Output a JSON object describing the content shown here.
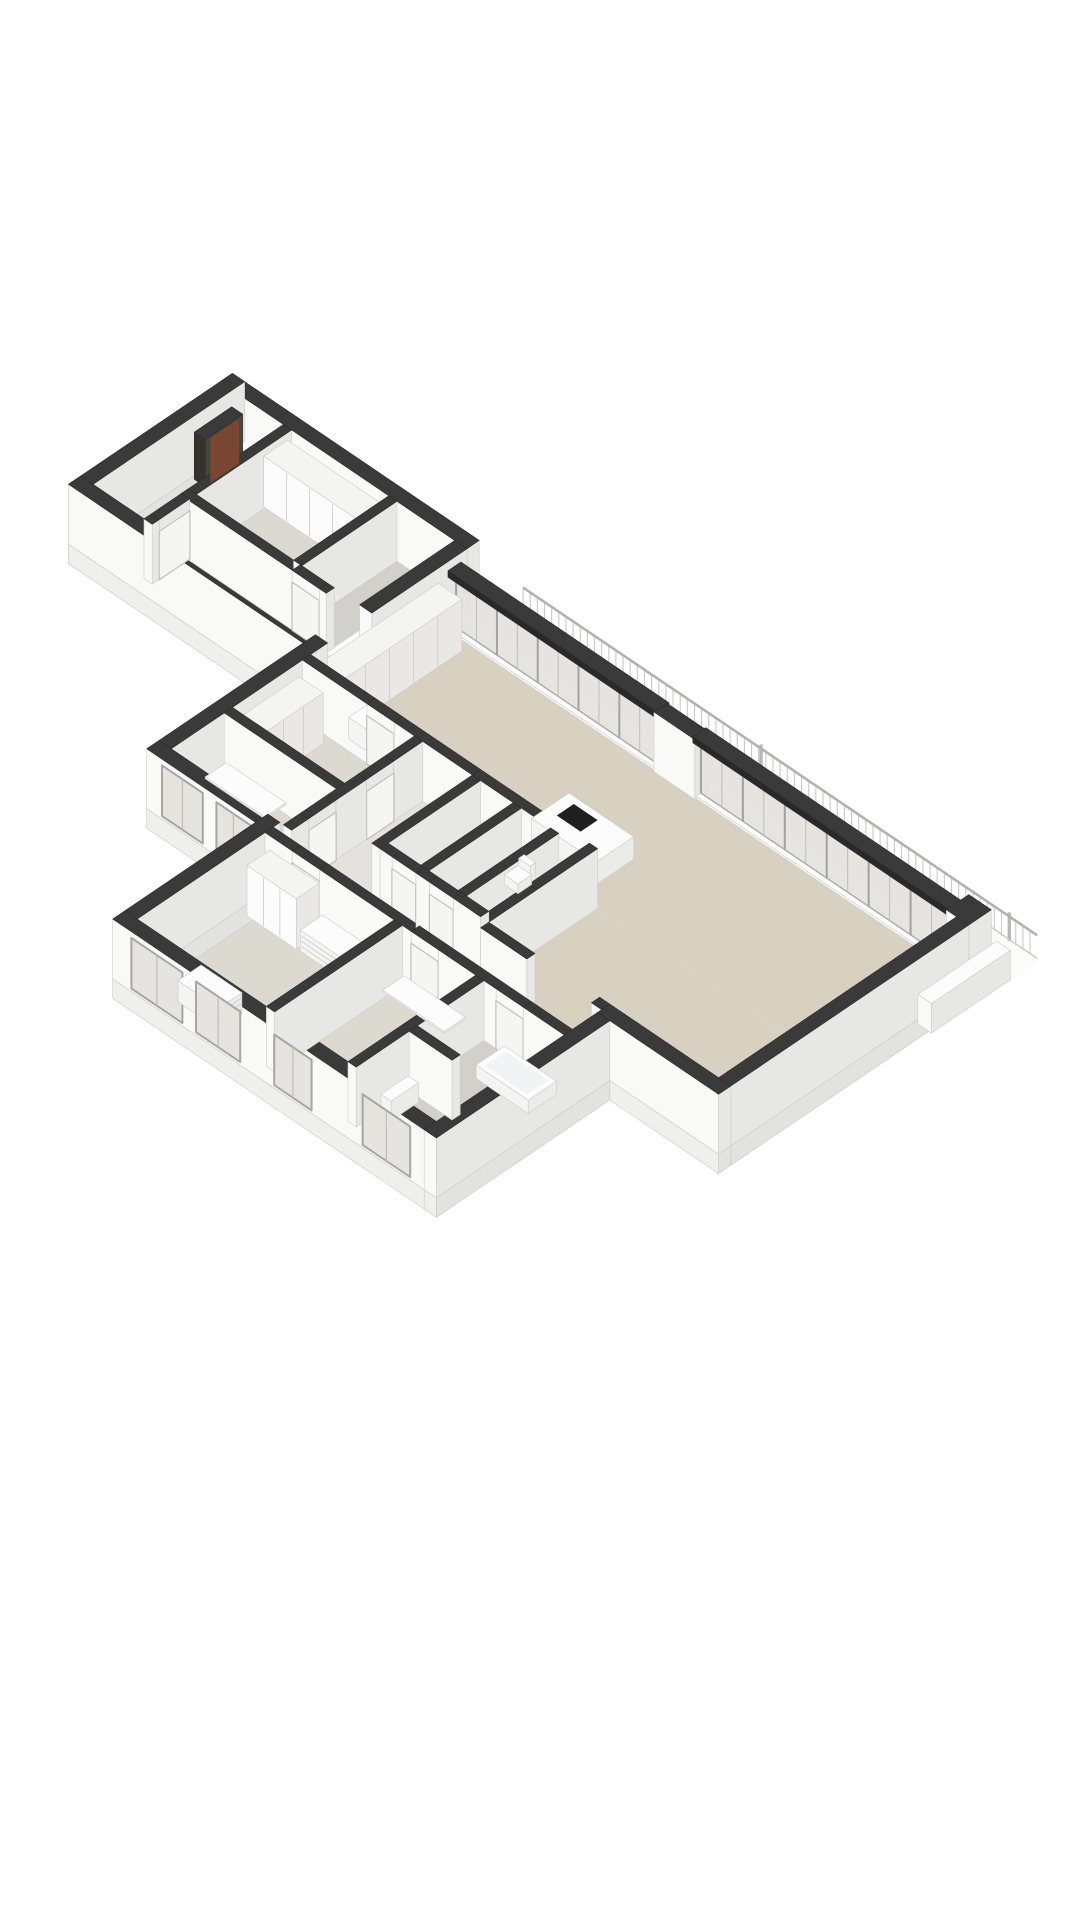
{
  "scene": {
    "kind": "isometric-3d-floorplan-render",
    "background": "#ffffff",
    "palette": {
      "cap": "#3a3a3b",
      "capEdge": "#2c2c2d",
      "capDark": "#29292a",
      "wallLight": "#f9f9f8",
      "wallShade": "#e7e7e6",
      "wallDim": "#dadad9",
      "floorBeige": "#d8d1c2",
      "floorGreige": "#dcd9d1",
      "floorGray": "#d2d0cb",
      "floorPale": "#e4e2de",
      "balcony": "#fbfbfa",
      "glass": "#e5e3de",
      "frame": "#a2a2a1",
      "frameThin": "#bdbdbc",
      "white": "#fcfcfc",
      "furnSide": "#f4f4f3",
      "furnShade": "#ebebe9",
      "cooktop": "#1f1f20",
      "slab": "#efefee",
      "slabSide": "#e2e2e1",
      "slabEdge": "#c9c9c8",
      "railing": "#c9c9c8",
      "railTop": "#b2b2b1",
      "post": "#b8b8b7",
      "door": "#f5f5f4",
      "doorStroke": "#b5b5b4",
      "cabinetFront": "#e9e8e6",
      "seam": "#c9c9c8",
      "meterDark": "#38322e",
      "meterFace": "#4a433e",
      "meterBrown": "#7a4531",
      "tubInner": "#f1f3f4",
      "faceStroke": "#cccccb"
    },
    "floors": [
      {
        "name": "balcony-terrace-floor",
        "rect": [
          0,
          -1.32,
          16.1,
          -0.36
        ],
        "color": "balcony"
      },
      {
        "name": "living-room-floor",
        "rect": [
          0,
          0,
          15.2,
          4.1
        ],
        "color": "floorBeige"
      },
      {
        "name": "living-room-floor-east",
        "rect": [
          8.44,
          4.1,
          15.2,
          7.3
        ],
        "color": "floorBeige"
      },
      {
        "name": "west-hall-floor",
        "rect": [
          3.54,
          4.34,
          5.0,
          7.3
        ],
        "color": "floorPale"
      },
      {
        "name": "core-storage-floor",
        "rect": [
          5.24,
          4.34,
          6.2,
          7.06
        ],
        "color": "floorGray"
      },
      {
        "name": "core-wc-floor",
        "rect": [
          6.44,
          4.34,
          7.3,
          7.06
        ],
        "color": "floorGray"
      },
      {
        "name": "core-shower-floor",
        "rect": [
          7.54,
          4.34,
          8.2,
          7.06
        ],
        "color": "floorGray"
      },
      {
        "name": "west-bedroom-floor",
        "rect": [
          0,
          4.34,
          3.3,
          6.4
        ],
        "color": "floorGreige"
      },
      {
        "name": "west-study-floor",
        "rect": [
          0,
          6.64,
          3.3,
          8.2
        ],
        "color": "floorGreige"
      },
      {
        "name": "south-hall-floor",
        "rect": [
          3.2,
          7.3,
          12.0,
          8.4
        ],
        "color": "floorBeige"
      },
      {
        "name": "bedroom-a-floor",
        "rect": [
          3.2,
          8.64,
          7.0,
          12.4
        ],
        "color": "floorGreige"
      },
      {
        "name": "bedroom-b-floor",
        "rect": [
          7.24,
          8.64,
          9.4,
          12.4
        ],
        "color": "floorGreige"
      },
      {
        "name": "bathroom-floor",
        "rect": [
          9.64,
          8.64,
          12.0,
          12.4
        ],
        "color": "floorGray"
      },
      {
        "name": "entry-room-floor",
        "rect": [
          -5.4,
          -0.5,
          -2.3,
          2.3
        ],
        "color": "floorGreige"
      },
      {
        "name": "entry-closet-floor",
        "rect": [
          -2.06,
          -0.5,
          -1.1,
          2.3
        ],
        "color": "floorGray"
      },
      {
        "name": "entry-corridor-floor",
        "rect": [
          -5.4,
          2.54,
          0,
          3.6
        ],
        "color": "floorPale"
      },
      {
        "name": "vestibule-floor",
        "rect": [
          -6.9,
          -0.5,
          -5.4,
          3.6
        ],
        "color": "floorPale"
      }
    ],
    "slab_edges": [
      {
        "name": "slab-south",
        "rect": [
          2.84,
          12.4,
          12.36,
          12.76
        ]
      },
      {
        "name": "slab-westblock-south",
        "rect": [
          -0.36,
          8.2,
          2.84,
          8.56
        ]
      },
      {
        "name": "slab-wing-west",
        "rect": [
          2.84,
          8.2,
          3.2,
          12.4
        ]
      },
      {
        "name": "slab-wing-east",
        "rect": [
          12.0,
          7.66,
          12.36,
          12.76
        ]
      },
      {
        "name": "slab-east",
        "rect": [
          15.2,
          0.3,
          15.56,
          7.3
        ]
      },
      {
        "name": "slab-se-step",
        "rect": [
          12.0,
          7.3,
          15.56,
          7.66
        ]
      },
      {
        "name": "slab-entry-south",
        "rect": [
          -7.26,
          3.6,
          0,
          3.96
        ]
      },
      {
        "name": "slab-vestibule-west",
        "rect": [
          -7.26,
          -0.86,
          -6.9,
          3.96
        ]
      }
    ],
    "exterior_walls": [
      {
        "name": "east-facade-wall",
        "rect": [
          15.2,
          0.3,
          15.56,
          7.3
        ]
      },
      {
        "name": "northeast-corner-pier",
        "rect": [
          14.9,
          -0.36,
          15.56,
          0.3
        ]
      },
      {
        "name": "se-step-wall",
        "rect": [
          12.0,
          7.3,
          15.56,
          7.66
        ]
      },
      {
        "name": "wing-east-facade-wall",
        "rect": [
          12.0,
          7.66,
          12.36,
          12.76
        ]
      },
      {
        "name": "south-facade-wall",
        "rect": [
          2.84,
          12.4,
          12.36,
          12.76
        ]
      },
      {
        "name": "wing-west-facade-wall",
        "rect": [
          2.84,
          8.2,
          3.2,
          12.4
        ]
      },
      {
        "name": "westblock-south-wall",
        "rect": [
          -0.36,
          8.2,
          2.84,
          8.56
        ]
      },
      {
        "name": "west-facade-wall",
        "rect": [
          -0.36,
          3.6,
          0,
          8.2
        ]
      },
      {
        "name": "northwest-facade-wall",
        "rect": [
          -0.36,
          -0.5,
          0,
          2.3
        ]
      },
      {
        "name": "glass-facade-pier",
        "rect": [
          6.3,
          -0.08,
          7.5,
          0.3
        ]
      },
      {
        "name": "entry-north-wall",
        "rect": [
          -7.26,
          -0.86,
          0,
          -0.5
        ]
      },
      {
        "name": "vestibule-west-wall",
        "rect": [
          -7.26,
          -0.86,
          -6.9,
          3.96
        ]
      },
      {
        "name": "entry-south-wall",
        "rect": [
          -7.26,
          3.6,
          0,
          3.96
        ]
      }
    ],
    "interior_walls": [
      {
        "name": "kitchen-north-wall-a",
        "rect": [
          0,
          4.1,
          1.9,
          4.34
        ]
      },
      {
        "name": "kitchen-north-wall-b",
        "rect": [
          2.7,
          4.1,
          5.0,
          4.34
        ]
      },
      {
        "name": "core-north-wall",
        "rect": [
          5.0,
          4.1,
          8.44,
          4.34
        ]
      },
      {
        "name": "west-hall-wall-a",
        "rect": [
          3.3,
          4.34,
          3.54,
          5.2
        ]
      },
      {
        "name": "west-hall-wall-b",
        "rect": [
          3.3,
          6.0,
          3.54,
          6.9
        ]
      },
      {
        "name": "west-hall-wall-c",
        "rect": [
          3.3,
          7.7,
          3.54,
          8.2
        ]
      },
      {
        "name": "west-rooms-partition",
        "rect": [
          0,
          6.4,
          3.3,
          6.64
        ]
      },
      {
        "name": "core-west-wall",
        "rect": [
          5.0,
          4.34,
          5.24,
          7.3
        ]
      },
      {
        "name": "core-partition-a",
        "rect": [
          6.2,
          4.34,
          6.44,
          7.06
        ]
      },
      {
        "name": "core-partition-b",
        "rect": [
          7.3,
          4.34,
          7.54,
          7.06
        ]
      },
      {
        "name": "core-east-wall",
        "rect": [
          8.2,
          4.1,
          8.44,
          7.3
        ]
      },
      {
        "name": "living-south-wall-a",
        "rect": [
          8.44,
          7.3,
          9.8,
          7.54
        ]
      },
      {
        "name": "living-south-wall-b",
        "rect": [
          11.7,
          7.3,
          12.0,
          7.54
        ]
      },
      {
        "name": "core-south-wall-a",
        "rect": [
          5.24,
          7.06,
          5.6,
          7.3
        ]
      },
      {
        "name": "core-south-wall-b",
        "rect": [
          6.3,
          7.06,
          6.7,
          7.3
        ]
      },
      {
        "name": "core-south-wall-c",
        "rect": [
          7.4,
          7.06,
          8.2,
          7.3
        ]
      },
      {
        "name": "south-hall-wall-a",
        "rect": [
          3.2,
          8.4,
          4.0,
          8.64
        ]
      },
      {
        "name": "south-hall-wall-b",
        "rect": [
          4.8,
          8.4,
          7.5,
          8.64
        ]
      },
      {
        "name": "south-hall-wall-c",
        "rect": [
          8.3,
          8.4,
          10.0,
          8.64
        ]
      },
      {
        "name": "south-hall-wall-d",
        "rect": [
          10.8,
          8.4,
          12.0,
          8.64
        ]
      },
      {
        "name": "bedroom-ab-partition",
        "rect": [
          7.0,
          8.64,
          7.24,
          12.4
        ]
      },
      {
        "name": "bathroom-west-wall",
        "rect": [
          9.4,
          8.64,
          9.64,
          12.4
        ]
      },
      {
        "name": "shower-divider-wall",
        "rect": [
          9.64,
          10.6,
          10.9,
          10.84
        ]
      },
      {
        "name": "entry-room-corridor-wall-a",
        "rect": [
          -5.4,
          2.3,
          -2.1,
          2.54
        ]
      },
      {
        "name": "entry-room-corridor-wall-b",
        "rect": [
          -1.3,
          2.3,
          -1.1,
          2.54
        ]
      },
      {
        "name": "entry-closet-partition",
        "rect": [
          -2.3,
          -0.5,
          -2.06,
          2.3
        ]
      },
      {
        "name": "vestibule-wall-a",
        "rect": [
          -5.4,
          -0.5,
          -5.16,
          2.5
        ]
      },
      {
        "name": "vestibule-wall-b",
        "rect": [
          -5.4,
          3.4,
          -5.16,
          3.6
        ]
      }
    ],
    "glass_runs": [
      {
        "name": "glass-sliding-wall-west",
        "u1": 0.3,
        "u2": 6.3,
        "panels": 5
      },
      {
        "name": "glass-sliding-wall-east",
        "u1": 7.5,
        "u2": 14.9,
        "panels": 6
      }
    ],
    "windows": [
      {
        "name": "west-study-window-1",
        "v": 8.57,
        "u1": 0.1,
        "u2": 1.3
      },
      {
        "name": "west-study-window-2",
        "v": 8.57,
        "u1": 1.7,
        "u2": 2.7
      },
      {
        "name": "bedroom-a-window-1",
        "v": 12.77,
        "u1": 3.4,
        "u2": 4.9
      },
      {
        "name": "bedroom-a-window-2",
        "v": 12.77,
        "u1": 5.3,
        "u2": 6.6
      },
      {
        "name": "bedroom-b-window",
        "v": 12.77,
        "u1": 7.6,
        "u2": 8.7
      },
      {
        "name": "bathroom-window",
        "v": 12.77,
        "u1": 10.2,
        "u2": 11.6
      }
    ],
    "doors": [
      {
        "name": "kitchen-hall-door",
        "axis": "u",
        "v": 4.34,
        "c1": 1.9,
        "c2": 2.7
      },
      {
        "name": "west-bedroom-door",
        "axis": "v",
        "u": 3.54,
        "c1": 5.2,
        "c2": 6.0
      },
      {
        "name": "west-study-door",
        "axis": "v",
        "u": 3.54,
        "c1": 6.9,
        "c2": 7.7
      },
      {
        "name": "core-storage-door",
        "axis": "u",
        "v": 7.3,
        "c1": 5.6,
        "c2": 6.3
      },
      {
        "name": "core-wc-door",
        "axis": "u",
        "v": 7.3,
        "c1": 6.7,
        "c2": 7.4
      },
      {
        "name": "bedroom-a-door",
        "axis": "u",
        "v": 8.64,
        "c1": 4.0,
        "c2": 4.8
      },
      {
        "name": "bedroom-b-door",
        "axis": "u",
        "v": 8.64,
        "c1": 7.5,
        "c2": 8.3
      },
      {
        "name": "bathroom-door",
        "axis": "u",
        "v": 8.64,
        "c1": 10.0,
        "c2": 10.8
      },
      {
        "name": "entry-room-door",
        "axis": "u",
        "v": 2.54,
        "c1": -2.1,
        "c2": -1.3
      },
      {
        "name": "vestibule-door",
        "axis": "v",
        "u": -5.16,
        "c1": 2.5,
        "c2": 3.4
      }
    ],
    "railing": {
      "name": "balcony-railing",
      "v": -1.25,
      "u1": 0.9,
      "u2": 16.02,
      "gap": 0.21,
      "h": 1.06,
      "posts": [
        7.9,
        15.2
      ]
    },
    "parapet": {
      "name": "balcony-parapet-wall",
      "rect": [
        15.66,
        -0.42,
        16.06,
        1.9
      ],
      "z": [
        0,
        1.28
      ],
      "key": 17
    },
    "furniture": [
      {
        "name": "kitchen-island",
        "rect": [
          6.0,
          2.5,
          7.9,
          3.6
        ],
        "z": [
          0,
          0.98
        ],
        "style": "white"
      },
      {
        "name": "kitchen-cooktop",
        "type": "flat",
        "rect": [
          6.32,
          2.68,
          7.02,
          3.18
        ],
        "z": 1.0,
        "color": "cooktop"
      },
      {
        "name": "kitchen-counter",
        "rect": [
          1.1,
          3.42,
          4.4,
          4.08
        ],
        "z": [
          0,
          0.95
        ],
        "style": "white",
        "seamsS": 5
      },
      {
        "name": "kitchen-tall-cabinets",
        "rect": [
          0.15,
          0.5,
          0.85,
          4.05
        ],
        "z": [
          0,
          2.25
        ],
        "style": "cabinet",
        "seamsE": 4
      },
      {
        "name": "entry-room-wardrobe",
        "rect": [
          -5.2,
          -0.42,
          -2.5,
          0.28
        ],
        "z": [
          0,
          2.2
        ],
        "style": "cabinet",
        "seamsS": 3
      },
      {
        "name": "bedroom-a-wardrobe",
        "rect": [
          3.45,
          8.75,
          4.9,
          9.42
        ],
        "z": [
          0,
          2.2
        ],
        "style": "cabinet",
        "seamsS": 2,
        "key": 14.4
      },
      {
        "name": "bedroom-a-dresser",
        "rect": [
          5.0,
          8.75,
          6.2,
          9.4
        ],
        "z": [
          0,
          0.92
        ],
        "style": "white",
        "drawersS": 3,
        "key": 14.95
      },
      {
        "name": "west-bedroom-wardrobe",
        "rect": [
          0.12,
          4.55,
          0.82,
          6.3
        ],
        "z": [
          0,
          2.2
        ],
        "style": "cabinet",
        "seamsE": 2
      },
      {
        "name": "bedroom-b-desk",
        "rect": [
          7.45,
          8.8,
          9.25,
          9.42
        ],
        "z": [
          0.7,
          0.78
        ],
        "style": "white",
        "key": 18.3
      },
      {
        "name": "west-study-desk",
        "rect": [
          0.2,
          6.78,
          1.95,
          7.4
        ],
        "z": [
          0.7,
          0.78
        ],
        "style": "white"
      },
      {
        "name": "hall-dresser",
        "rect": [
          4.3,
          11.62,
          5.5,
          12.3
        ],
        "z": [
          0,
          0.92
        ],
        "style": "white",
        "drawersE": 3
      },
      {
        "name": "bathtub",
        "rect": [
          10.35,
          8.75,
          11.88,
          9.58
        ],
        "z": [
          0,
          0.58
        ],
        "style": "white"
      },
      {
        "name": "bathtub-inner",
        "type": "flat",
        "rect": [
          10.5,
          8.86,
          11.75,
          9.47
        ],
        "z": 0.6,
        "color": "tubInner"
      },
      {
        "name": "toilet-bowl",
        "rect": [
          6.55,
          4.55,
          6.95,
          4.95
        ],
        "z": [
          0,
          0.42
        ],
        "style": "white"
      },
      {
        "name": "toilet-cistern",
        "rect": [
          6.58,
          4.4,
          6.92,
          4.56
        ],
        "z": [
          0,
          0.78
        ],
        "style": "white"
      },
      {
        "name": "bathroom-washbasin",
        "rect": [
          9.72,
          10.95,
          10.02,
          11.75
        ],
        "z": [
          0,
          0.85
        ],
        "style": "white"
      },
      {
        "name": "meter-cabinet",
        "rect": [
          -6.82,
          -0.4,
          -6.5,
          0.7
        ],
        "z": [
          0,
          2.05
        ],
        "style": "meter"
      },
      {
        "name": "meter-cabinet-stripe",
        "type": "flatE",
        "rect": [
          -6.5,
          -0.3,
          -6.5,
          0.55
        ],
        "z": [
          0,
          1.95
        ],
        "color": "meterBrown"
      }
    ]
  }
}
